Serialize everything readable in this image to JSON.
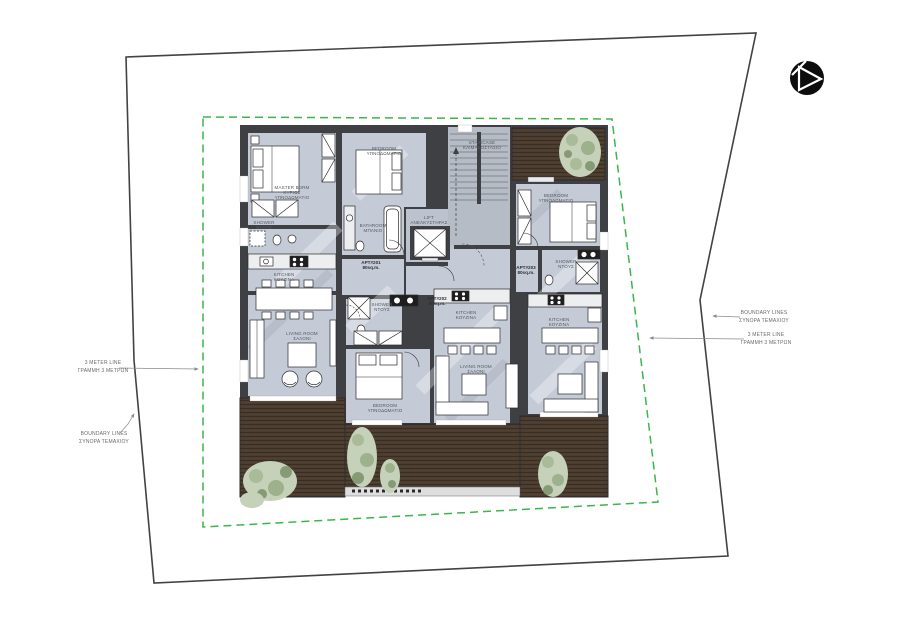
{
  "annotations": {
    "boundary_left": {
      "line1": "BOUNDARY LINES",
      "line2": "ΣΥΝΟΡΑ ΤΕΜΑΧΙΟΥ"
    },
    "meter_left": {
      "line1": "3 METER LINE",
      "line2": "ΓΡΑΜΜΗ 3 ΜΕΤΡΩΝ"
    },
    "boundary_right": {
      "line1": "BOUNDARY LINES",
      "line2": "ΣΥΝΟΡΑ ΤΕΜΑΧΙΟΥ"
    },
    "meter_right": {
      "line1": "3 METER LINE",
      "line2": "ΓΡΑΜΜΗ 3 ΜΕΤΡΩΝ"
    }
  },
  "apartments": {
    "apt201": {
      "id": "APT#201",
      "area": "80sq.m."
    },
    "apt202": {
      "id": "APT#202",
      "area": "80sq.m."
    },
    "apt203": {
      "id": "APT#203",
      "area": "80sq.m."
    }
  },
  "rooms": {
    "master_bedroom": {
      "en": "MASTER BDRM",
      "gr_line1": "ΚΥΡΙΩΣ",
      "gr_line2": "ΥΠΝΟΔΩΜΑΤΙΟ"
    },
    "bedroom": {
      "en": "BEDROOM",
      "gr": "ΥΠΝΟΔΩΜΑΤΙΟ"
    },
    "bathroom": {
      "en": "BATHROOM",
      "gr": "ΜΠΑΝΙΟ"
    },
    "shower": {
      "en": "SHOWER",
      "gr": "ΝΤΟΥΣ"
    },
    "kitchen": {
      "en": "KITCHEN",
      "gr": "ΚΟΥΖΙΝΑ"
    },
    "living_room": {
      "en": "LIVING ROOM",
      "gr": "ΣΑΛΟΝΙ"
    },
    "lift": {
      "en": "LIFT",
      "gr": "ΑΝΕΛΚΥΣΤΗΡΑΣ"
    },
    "staircase": {
      "en": "STAIRCASE",
      "gr": "ΚΛΙΜΑΚΟΣΤΑΣΙΟ"
    }
  },
  "colors": {
    "paper": "#ffffff",
    "boundary_line": "#424242",
    "setback_line": "#3cb54a",
    "wall": "#3f4044",
    "floor": "#c4cbd6",
    "stair_floor": "#b6bcc6",
    "deck_wood": "#4a3c2f",
    "plant": "#c2cfb4",
    "label_text": "#565a61"
  }
}
